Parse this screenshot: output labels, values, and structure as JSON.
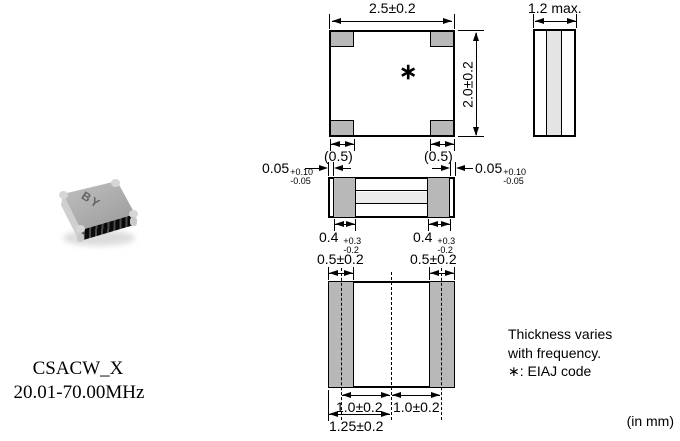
{
  "part": {
    "series": "CSACW_X",
    "frequency_range": "20.01-70.00MHz",
    "marking": "BY"
  },
  "top_view": {
    "width_dim": "2.5±0.2",
    "height_dim": "2.0±0.2",
    "corner_dim_left": "(0.5)",
    "corner_dim_right": "(0.5)",
    "eiaj_mark": "∗"
  },
  "side_view": {
    "thickness_dim": "1.2 max."
  },
  "front_view": {
    "gap_left_value": "0.05",
    "gap_left_plus": "+0.10",
    "gap_left_minus": "-0.05",
    "gap_right_value": "0.05",
    "gap_right_plus": "+0.10",
    "gap_right_minus": "-0.05",
    "cap_left_value": "0.4",
    "cap_left_plus": "+0.3",
    "cap_left_minus": "-0.2",
    "cap_right_value": "0.4",
    "cap_right_plus": "+0.3",
    "cap_right_minus": "-0.2",
    "terminal_left": "0.5±0.2",
    "terminal_right": "0.5±0.2"
  },
  "bottom_view": {
    "pitch_left": "1.0±0.2",
    "pitch_right": "1.0±0.2",
    "center_offset": "1.25±0.2"
  },
  "notes": {
    "line1": "Thickness varies",
    "line2": "with frequency.",
    "line3": "∗: EIAJ code"
  },
  "units_note": "(in mm)"
}
